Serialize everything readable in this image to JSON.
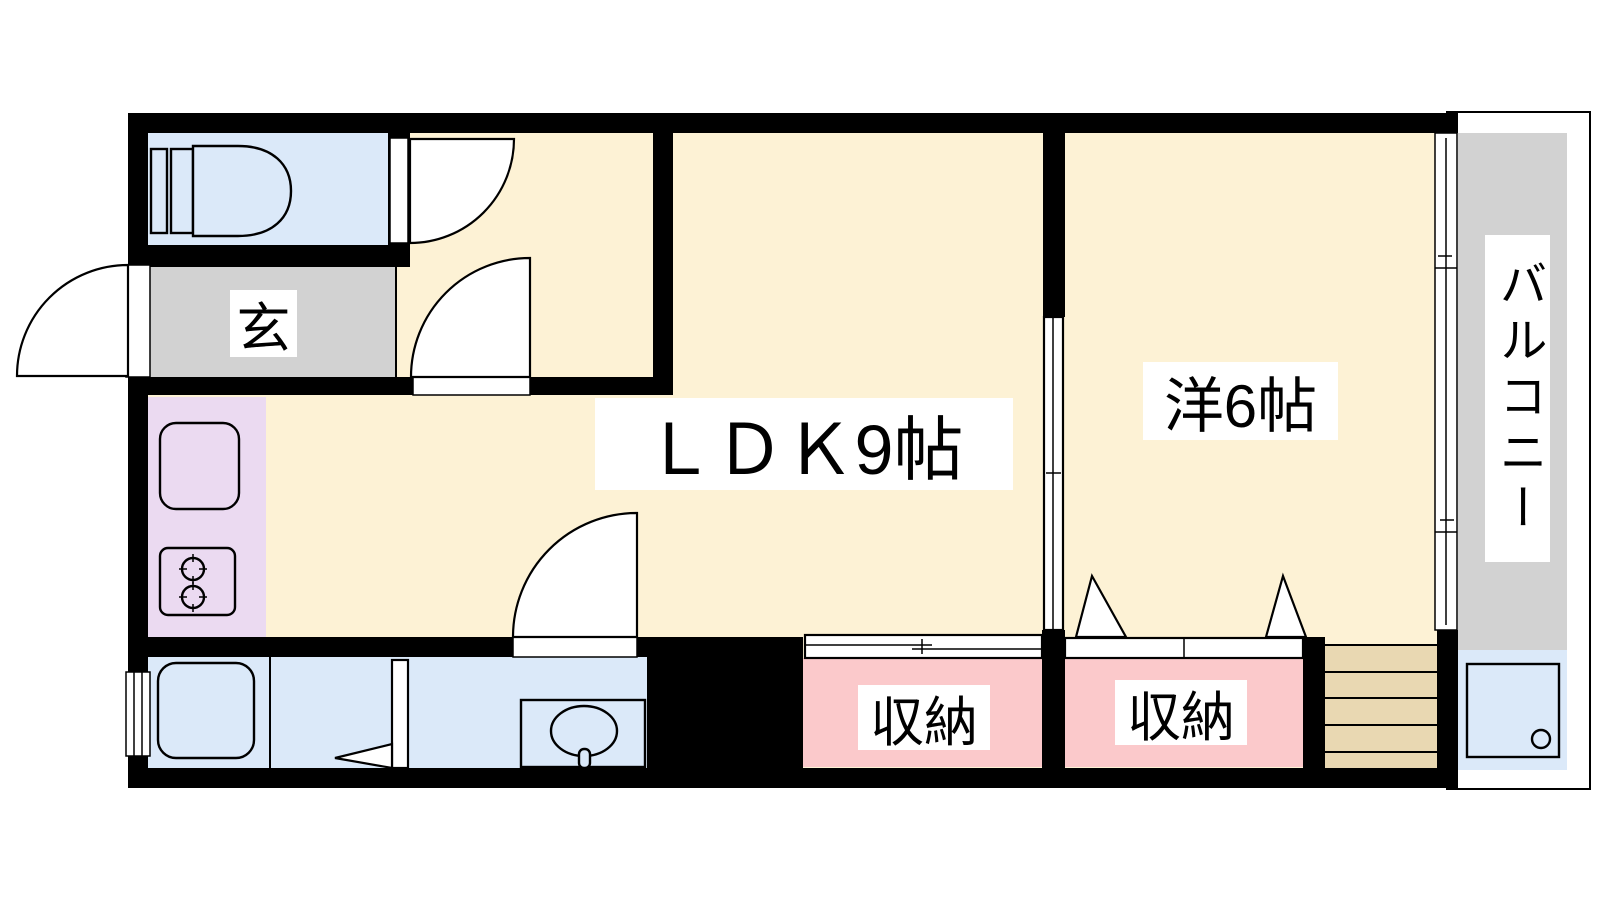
{
  "plan": {
    "title": "apartment floor plan",
    "rooms": {
      "entrance": {
        "label": "玄"
      },
      "ldk": {
        "label": "ＬＤＫ9帖"
      },
      "western_room": {
        "label": "洋6帖"
      },
      "closet_left": {
        "label": "収納"
      },
      "closet_right": {
        "label": "収納"
      },
      "balcony": {
        "label": "バルコニー"
      }
    },
    "fixtures": [
      "toilet-icon",
      "bathtub-icon",
      "washbasin-icon",
      "kitchen-sink-icon",
      "gas-stove-icon",
      "washing-machine-pan-icon",
      "staircase-icon"
    ],
    "colors": {
      "floor-cream": "#fdf2d5",
      "wet-area-blue": "#dbe9f9",
      "entrance-gray": "#d2d2d2",
      "kitchen-purple": "#ebdaf1",
      "closet-pink": "#fbc9cb",
      "stairs-beige": "#e9d8b2",
      "wall-black": "#000000",
      "label-bg": "#ffffff",
      "line": "#000000"
    }
  }
}
